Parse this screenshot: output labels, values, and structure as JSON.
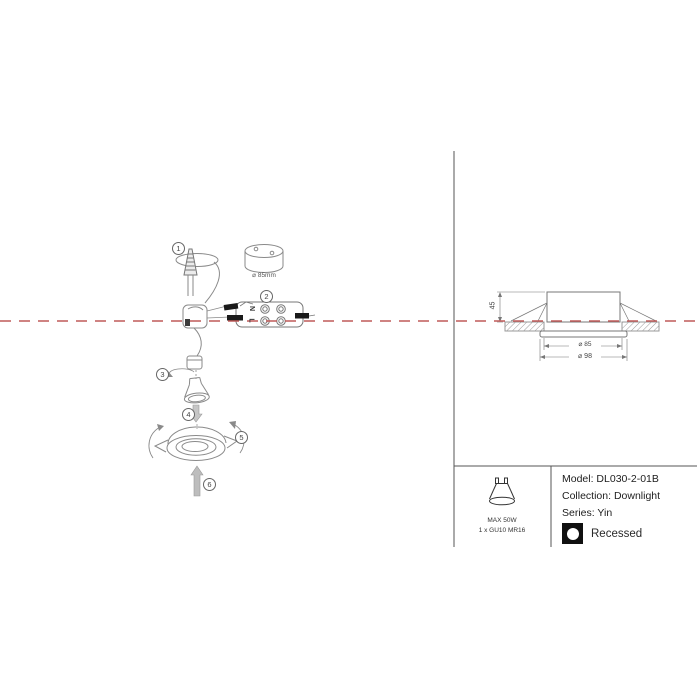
{
  "colors": {
    "accent": "#bf5a58",
    "line": "#777777"
  },
  "steps": [
    "1",
    "2",
    "3",
    "4",
    "5",
    "6"
  ],
  "install_diagram": {
    "hole_diameter_label": "⌀ 85mm",
    "terminal_neutral": "N",
    "terminal_live": "L"
  },
  "dimension_drawing": {
    "height": "45",
    "cutout_diameter": "⌀ 85",
    "overall_diameter": "⌀ 98"
  },
  "lamp_spec": {
    "max_power": "MAX 50W",
    "lamp_type": "1 x GU10 MR16"
  },
  "product_info": {
    "model": "Model: DL030-2-01B",
    "collection": "Collection: Downlight",
    "series": "Series: Yin",
    "mounting": "Recessed"
  },
  "icons": {
    "lamp": "gu10-lamp-icon",
    "mounting": "recessed-circle-icon"
  }
}
